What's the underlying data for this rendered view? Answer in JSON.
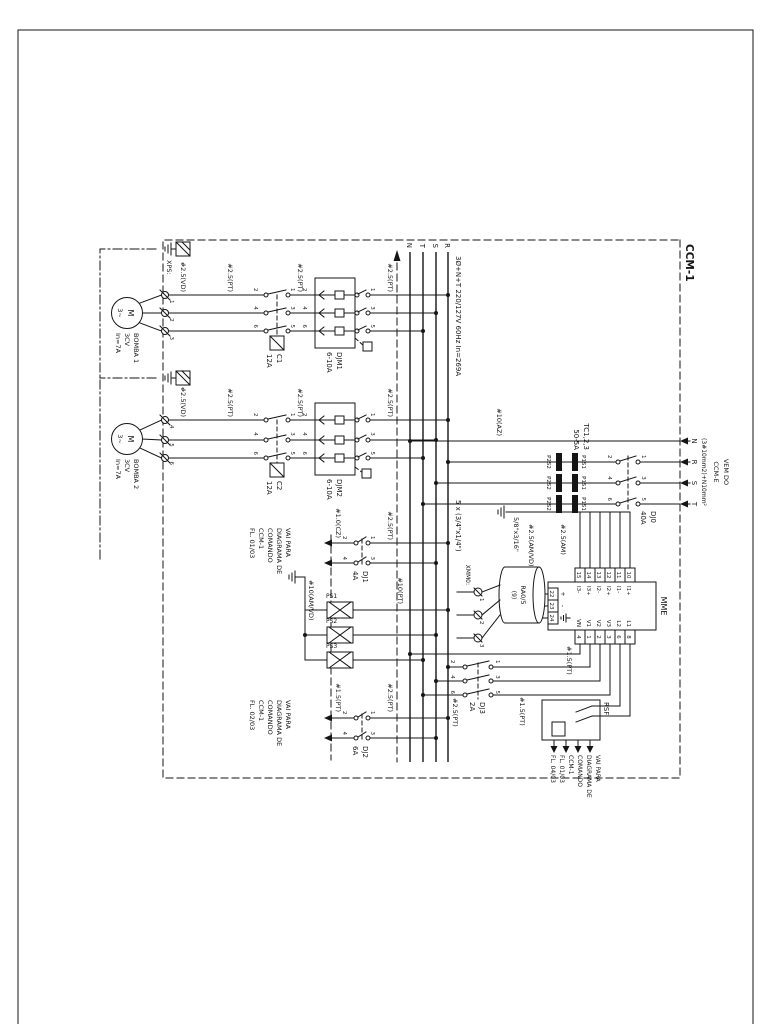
{
  "sheet": {
    "enclosure_label": "CCM-1",
    "xps_label": "XPS:"
  },
  "incoming": {
    "l1": "VEM DO",
    "l2": "CCM-E",
    "l3": "(3#10mm2)+N10mm²",
    "phases": [
      "N",
      "R",
      "S",
      "T"
    ]
  },
  "buses": {
    "letters": [
      "R",
      "S",
      "T",
      "N"
    ],
    "system_spec": "3Ø+N+T 220/127V 60Hz In=269A",
    "bar_spec": "5 x (3/4\"x1/4\")",
    "sec_bar_spec": "5/8\"x3/16\""
  },
  "devices": {
    "dj0": {
      "name": "DJ0",
      "rating": "40A"
    },
    "djm1": {
      "name": "DJM1",
      "rating": "6-10A"
    },
    "djm2": {
      "name": "DJM2",
      "rating": "6-10A"
    },
    "c1": {
      "name": "C1",
      "rating": "12A"
    },
    "c2": {
      "name": "C2",
      "rating": "12A"
    },
    "dj1": {
      "name": "DJ1",
      "rating": "4A"
    },
    "dj2": {
      "name": "DJ2",
      "rating": "6A"
    },
    "dj3": {
      "name": "DJ3",
      "rating": "2A"
    },
    "rsf": {
      "name": "RSF"
    },
    "tc": {
      "l1": "TC1,2,3",
      "l2": "50-5A",
      "top": "P1S1",
      "bottom": "P2S2"
    },
    "transducer": {
      "l1": "RA0/5",
      "l2": "(9)"
    },
    "xmm0": {
      "label": "XMM0:",
      "t": [
        "1",
        "2",
        "3"
      ]
    },
    "ps": [
      "PS1",
      "PS2",
      "PS3"
    ]
  },
  "mme": {
    "name": "MME",
    "left": [
      {
        "n": "10",
        "s": "I1+"
      },
      {
        "n": "11",
        "s": "I1-"
      },
      {
        "n": "12",
        "s": "I2+"
      },
      {
        "n": "13",
        "s": "I2-"
      },
      {
        "n": "14",
        "s": "I3+"
      },
      {
        "n": "15",
        "s": "I3-"
      }
    ],
    "right": [
      {
        "n": "8",
        "s": "L1"
      },
      {
        "n": "6",
        "s": "L2"
      },
      {
        "n": "3",
        "s": "V3"
      },
      {
        "n": "2",
        "s": "V2"
      },
      {
        "n": "1",
        "s": "V1"
      },
      {
        "n": "4",
        "s": "VN"
      }
    ],
    "aux": [
      {
        "n": "22",
        "s": "+"
      },
      {
        "n": "23",
        "s": "-"
      },
      {
        "n": "24",
        "s": "earth-icon"
      }
    ]
  },
  "motors": {
    "m1": {
      "l1": "BOMBA 1",
      "l2": "3CV",
      "l3": "In=7A",
      "sym1": "M",
      "sym2": "3~"
    },
    "m2": {
      "l1": "BOMBA 2",
      "l2": "3CV",
      "l3": "In=7A",
      "sym1": "M",
      "sym2": "3~"
    }
  },
  "wires": {
    "vd25": "#2.5(VD)",
    "pt25": "#2.5(PT)",
    "pt15": "#1.5(PT)",
    "pt10": "#10(PT)",
    "cz10": "#1.0(CZ)",
    "az10": "#10(AZ)",
    "am25": "#2.5(AM)",
    "amvd25": "#2.5(AM/VD)",
    "amvd10": "#10(AM/VD)"
  },
  "goto": {
    "l1": "VAI PARA",
    "l2": "DIAGRAMA DE",
    "l3": "COMANDO",
    "l4": "CCM-1",
    "fl1": "FL. 01/03",
    "fl2": "FL. 02/03",
    "fl4": "FL. 04/03"
  },
  "terms": {
    "odd3": "1 3 5",
    "even3": "2 4 6",
    "odd2": "1 3",
    "even2": "2 4",
    "m1": "1 2 3",
    "m2": "4 5 6"
  }
}
